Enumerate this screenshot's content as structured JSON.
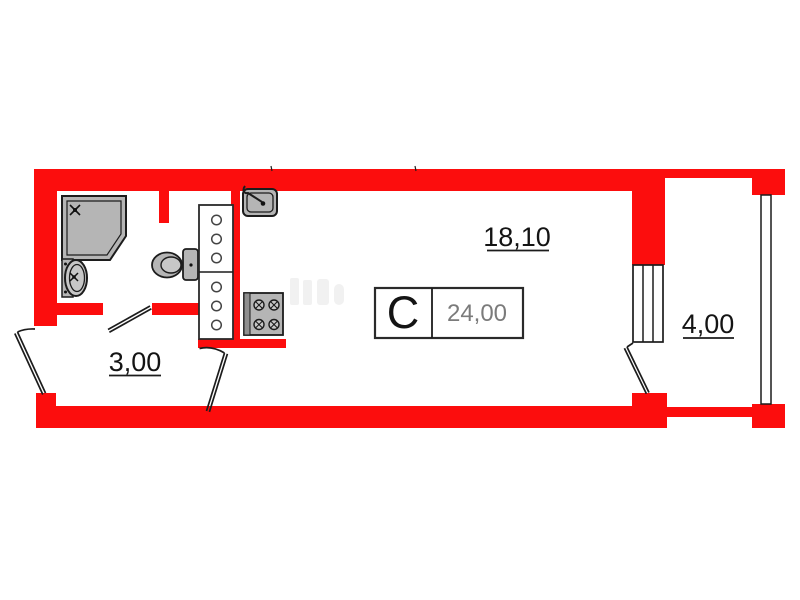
{
  "plan": {
    "unit_type_label": "С",
    "total_area": "24,00",
    "areas": {
      "living_room": "18,10",
      "hallway": "3,00",
      "balcony": "4,00"
    },
    "colors": {
      "wall_red": "#fc0d0d",
      "outline_black": "#1c1c1c",
      "fixture_gray": "#b5b5b5",
      "fixture_gray_light": "#c7c7c7",
      "total_area_text_gray": "#7b7b7b",
      "background": "#ffffff"
    }
  }
}
